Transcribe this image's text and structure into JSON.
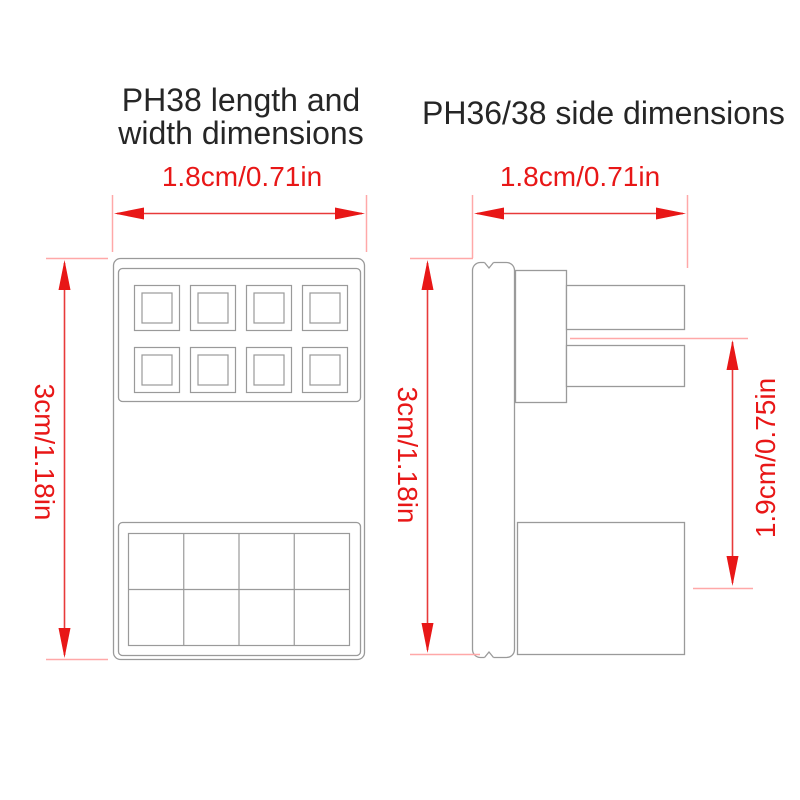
{
  "colors": {
    "dimension_red": "#e81717",
    "extension_pink": "#ffa8a8",
    "outline_gray": "#9a9a9a",
    "title_color": "#262626",
    "background": "#ffffff"
  },
  "left_figure": {
    "title_line1": "PH38 length and",
    "title_line2": "width dimensions",
    "width_dimension": "1.8cm/0.71in",
    "height_dimension": "3cm/1.18in"
  },
  "right_figure": {
    "title": "PH36/38 side dimensions",
    "width_dimension": "1.8cm/0.71in",
    "height_dimension": "3cm/1.18in",
    "depth_dimension": "1.9cm/0.75in"
  }
}
